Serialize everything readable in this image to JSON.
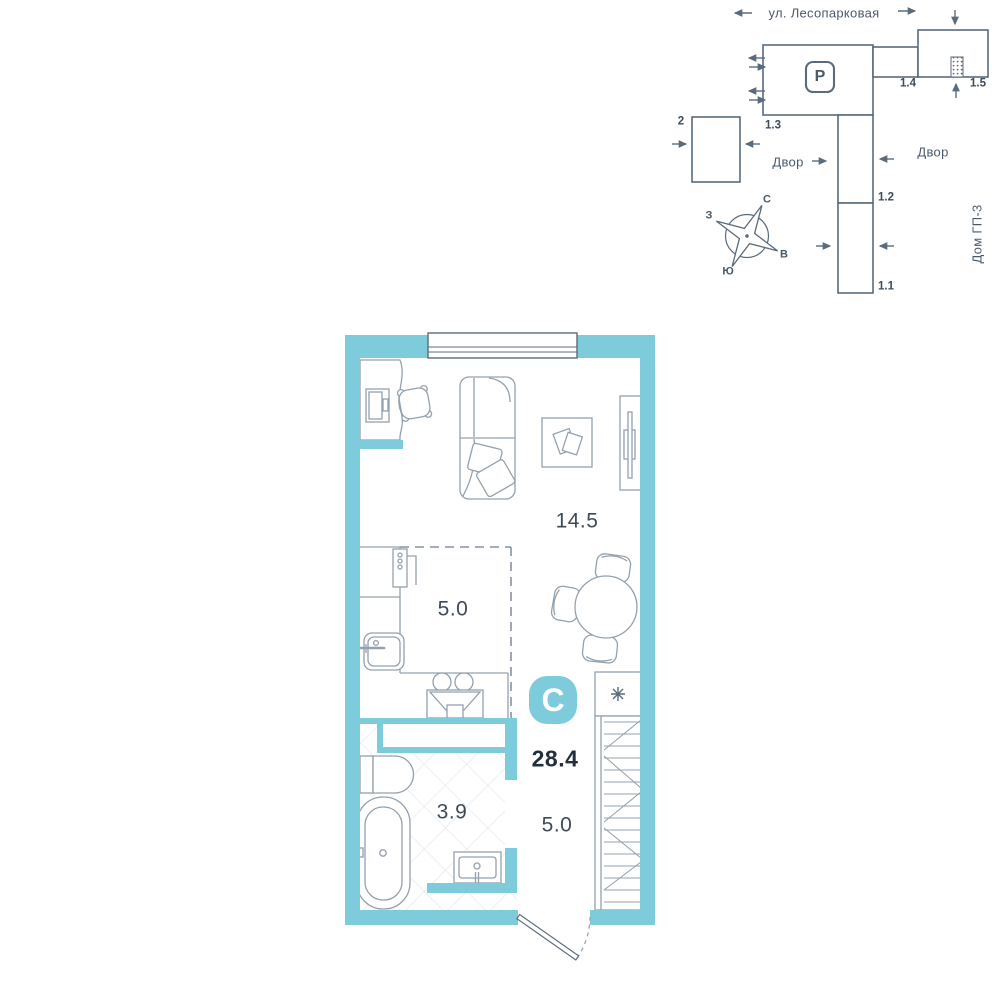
{
  "site_plan": {
    "street_name": "ул. Лесопарковая",
    "parking_label": "P",
    "buildings": {
      "b2": "2",
      "b13": "1.3",
      "b14": "1.4",
      "b15": "1.5",
      "b12": "1.2",
      "b11": "1.1"
    },
    "yard_label_left": "Двор",
    "yard_label_right": "Двор",
    "house_label": "Дом ГП-3",
    "compass": {
      "north": "С",
      "south": "Ю",
      "west": "З",
      "east": "В"
    }
  },
  "floor_plan": {
    "type_badge": "С",
    "total_area": "28.4",
    "living_area": "14.5",
    "kitchen_area": "5.0",
    "bathroom_area": "3.9",
    "hall_area": "5.0",
    "appliance_icon": "snowflake-asterisk"
  },
  "colors": {
    "wall_teal": "#7ECBDC",
    "line_slate": "#5A6B7C",
    "furniture_line": "#93A1AE",
    "text_dark": "#232F3B"
  }
}
